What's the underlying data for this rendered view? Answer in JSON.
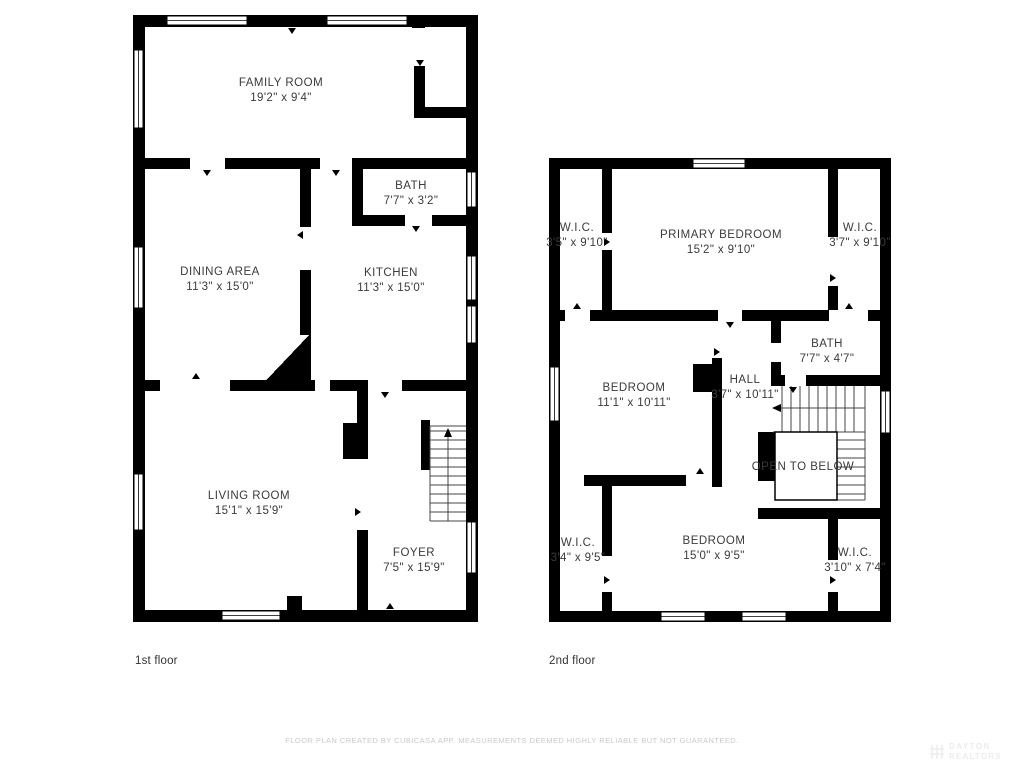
{
  "floor1": {
    "caption": "1st floor",
    "rooms": [
      {
        "name": "FAMILY ROOM",
        "dims": "19'2\" x 9'4\""
      },
      {
        "name": "BATH",
        "dims": "7'7\" x 3'2\""
      },
      {
        "name": "DINING AREA",
        "dims": "11'3\" x 15'0\""
      },
      {
        "name": "KITCHEN",
        "dims": "11'3\" x 15'0\""
      },
      {
        "name": "LIVING ROOM",
        "dims": "15'1\" x 15'9\""
      },
      {
        "name": "FOYER",
        "dims": "7'5\" x 15'9\""
      }
    ]
  },
  "floor2": {
    "caption": "2nd floor",
    "rooms": [
      {
        "name": "W.I.C.",
        "dims": "3'5\" x 9'10\""
      },
      {
        "name": "PRIMARY BEDROOM",
        "dims": "15'2\" x 9'10\""
      },
      {
        "name": "W.I.C.",
        "dims": "3'7\" x 9'10\""
      },
      {
        "name": "BEDROOM",
        "dims": "11'1\" x 10'11\""
      },
      {
        "name": "HALL",
        "dims": "3'7\" x 10'11\""
      },
      {
        "name": "BATH",
        "dims": "7'7\" x 4'7\""
      },
      {
        "name": "OPEN TO BELOW",
        "dims": ""
      },
      {
        "name": "W.I.C.",
        "dims": "3'4\" x 9'5\""
      },
      {
        "name": "BEDROOM",
        "dims": "15'0\" x 9'5\""
      },
      {
        "name": "W.I.C.",
        "dims": "3'10\" x 7'4\""
      }
    ]
  },
  "footer": {
    "disclaimer": "FLOOR PLAN CREATED BY CUBICASA APP. MEASUREMENTS DEEMED HIGHLY RELIABLE BUT NOT GUARANTEED."
  },
  "watermark": {
    "line1": "DAYTON",
    "line2": "REALTORS"
  },
  "colors": {
    "wall": "#000000",
    "text": "#3b3b3b",
    "footer_text": "#c9c9c9"
  }
}
